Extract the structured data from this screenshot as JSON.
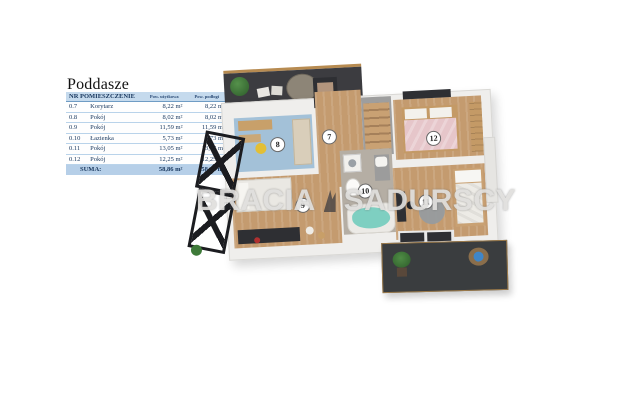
{
  "title": "Poddasze",
  "watermark": {
    "left": "BRACIA",
    "right": "SADURSCY"
  },
  "table": {
    "header_main": "NR POMIESZCZENIE",
    "header_area_1": "Pow. użytkowa",
    "header_area_2": "Pow. podłogi",
    "rows": [
      {
        "nr": "0.7",
        "name": "Korytarz",
        "area1": "8,22 m²",
        "area2": "8,22 m²"
      },
      {
        "nr": "0.8",
        "name": "Pokój",
        "area1": "8,02 m²",
        "area2": "8,02 m²"
      },
      {
        "nr": "0.9",
        "name": "Pokój",
        "area1": "11,59 m²",
        "area2": "11,59 m²"
      },
      {
        "nr": "0.10",
        "name": "Łazienka",
        "area1": "5,73 m²",
        "area2": "5,73 m²"
      },
      {
        "nr": "0.11",
        "name": "Pokój",
        "area1": "13,05 m²",
        "area2": "13,05 m²"
      },
      {
        "nr": "0.12",
        "name": "Pokój",
        "area1": "12,25 m²",
        "area2": "12,25 m²"
      }
    ],
    "suma": {
      "label": "SUMA:",
      "area1": "58,86 m²",
      "area2": "58,86 m²"
    }
  },
  "plan": {
    "badges": [
      "7",
      "8",
      "9",
      "10",
      "11",
      "12"
    ]
  },
  "colors": {
    "table_header_bg": "#c5daed",
    "table_suma_bg": "#b6cfe8",
    "table_text": "#17365d",
    "floor_wood": "#c49b6f",
    "floor_room8_blue": "#a3c1d8",
    "floor_bathroom": "#b5aea4",
    "terrace_dark": "#3a3d3f",
    "bathtub_water": "#7ecfc1",
    "bed_pink": "#e6c6ca",
    "chair_yellow": "#e3bf35",
    "watermark_grey": "#e0dfdd"
  }
}
